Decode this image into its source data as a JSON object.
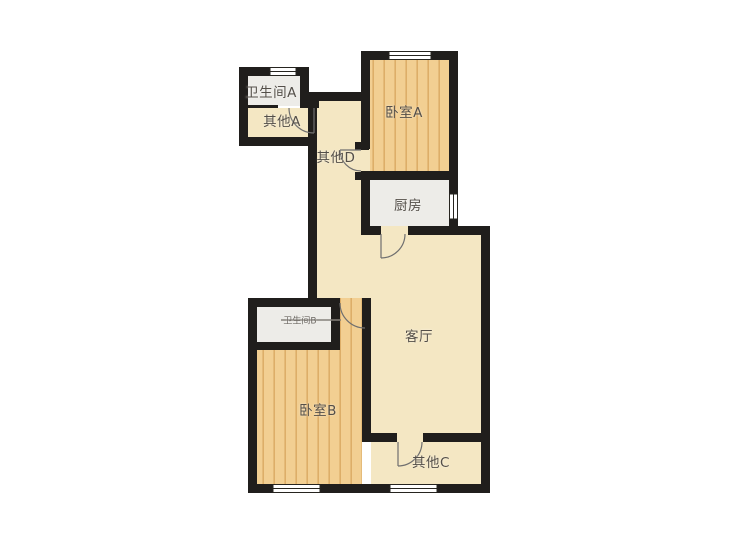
{
  "floorplan": {
    "rooms": [
      {
        "id": "bathroom-a",
        "label": "卫生间A"
      },
      {
        "id": "other-a",
        "label": "其他A"
      },
      {
        "id": "other-d",
        "label": "其他D"
      },
      {
        "id": "bedroom-a",
        "label": "卧室A"
      },
      {
        "id": "kitchen",
        "label": "厨房"
      },
      {
        "id": "living-room",
        "label": "客厅"
      },
      {
        "id": "bathroom-b",
        "label": "卫生间B"
      },
      {
        "id": "bedroom-b",
        "label": "卧室B"
      },
      {
        "id": "other-c",
        "label": "其他C"
      }
    ],
    "colors": {
      "wall": "#201e1c",
      "wood_floor": "#f2cf92",
      "wood_stripe": "#ddae68",
      "tile_floor": "#edece8",
      "plaster_floor": "#f4e7c3",
      "label_text": "#544f49",
      "door_stroke": "#6f6f6f",
      "window_line": "#26241f",
      "background": "#ffffff"
    }
  }
}
